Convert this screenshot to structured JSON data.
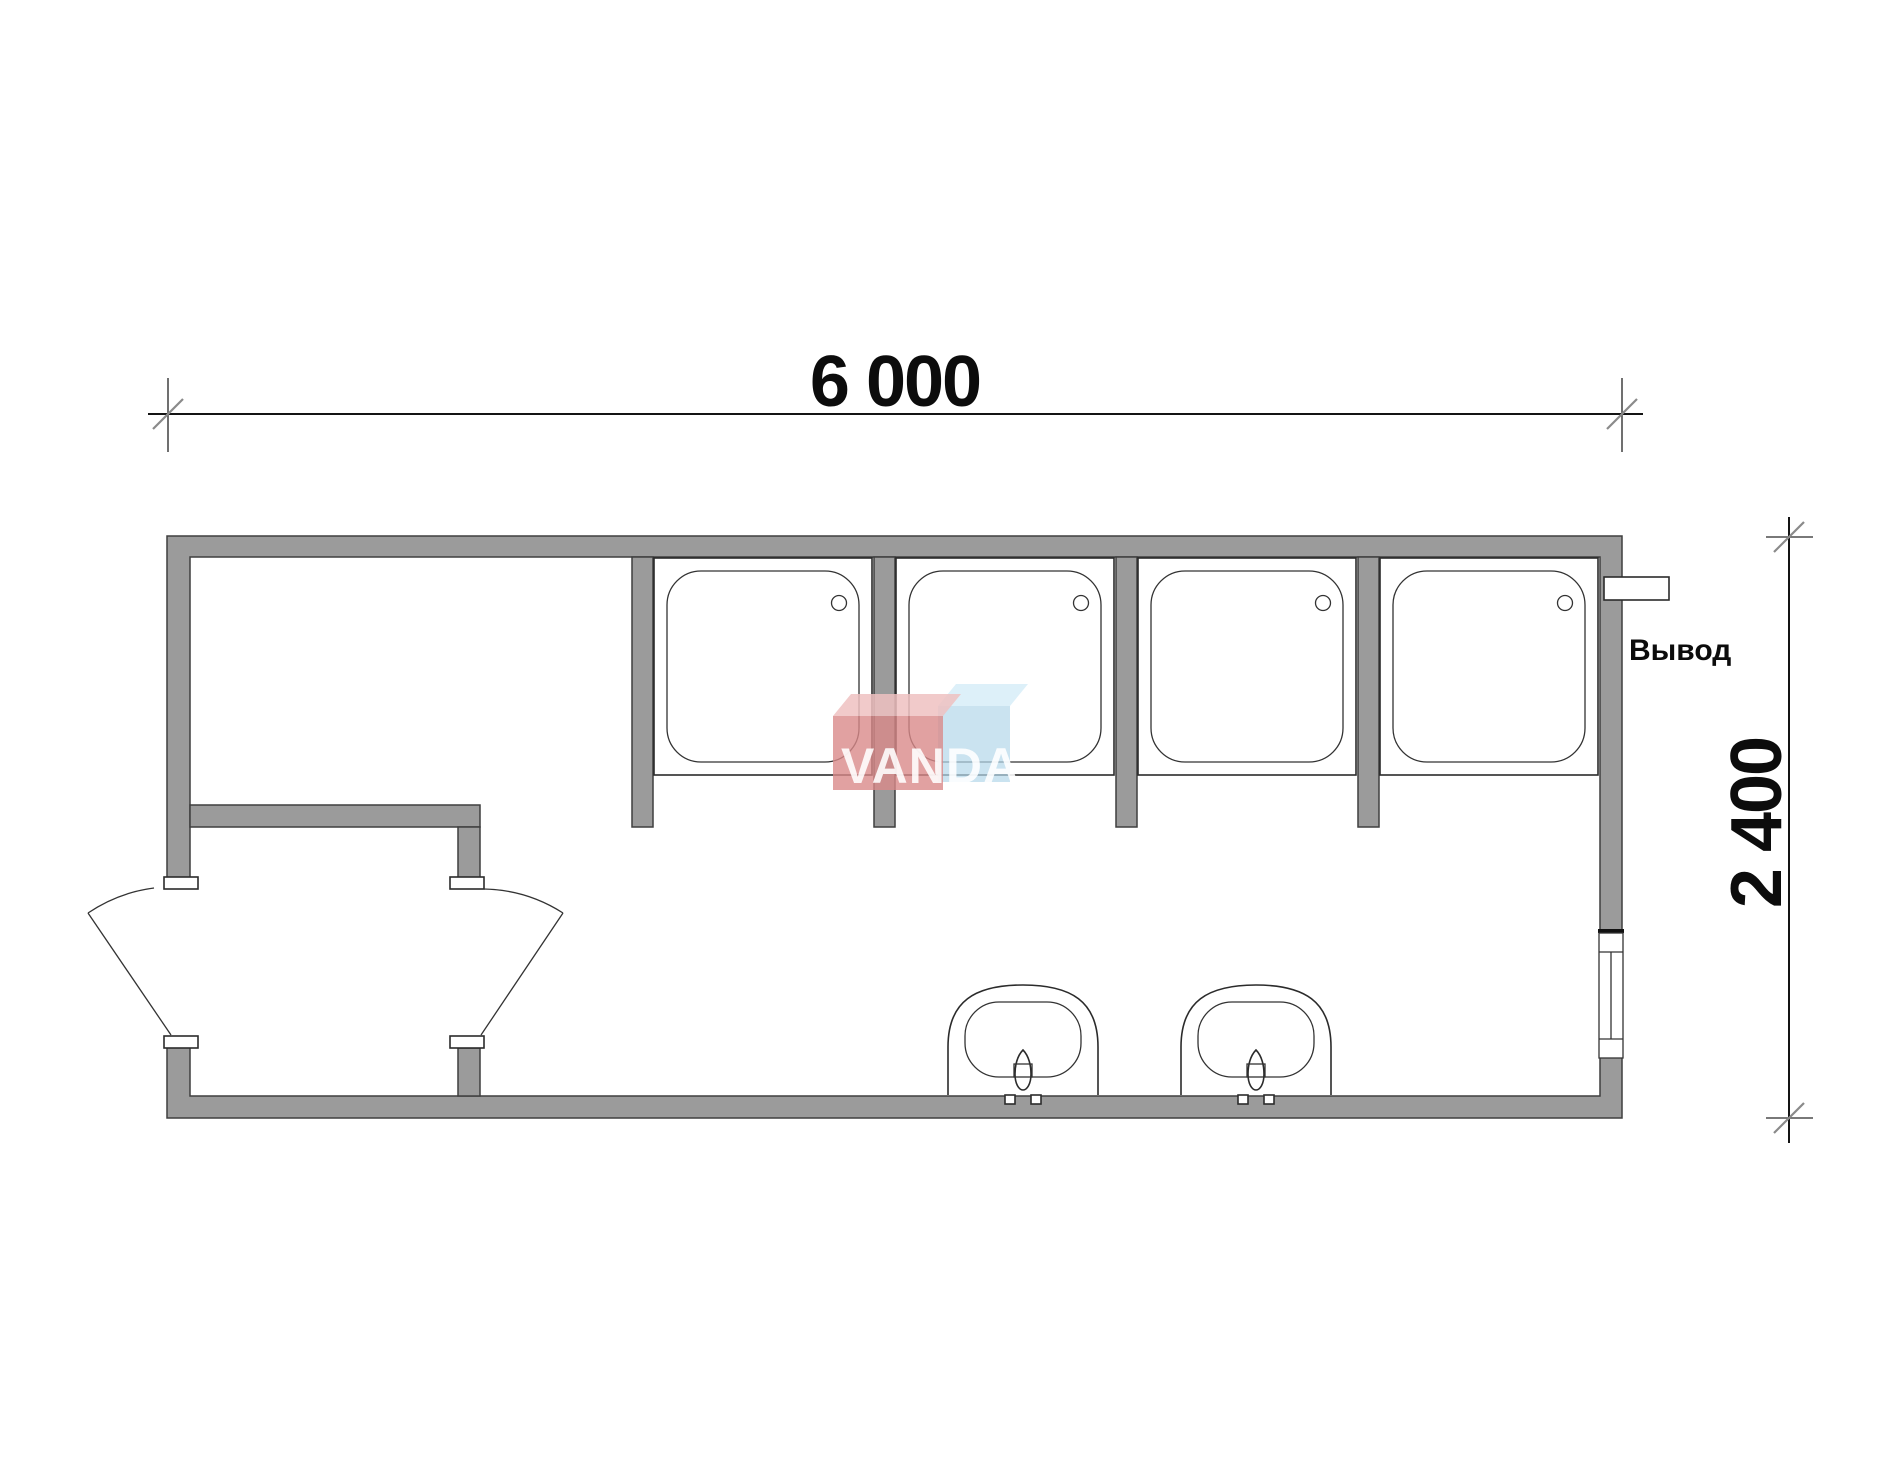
{
  "page": {
    "background": "#ffffff"
  },
  "dimensions": {
    "width": {
      "label": "6 000"
    },
    "height": {
      "label": "2 400"
    }
  },
  "annotations": {
    "outlet_label": "Вывод"
  },
  "watermark": {
    "brand": "VANDA"
  },
  "palette": {
    "wall_fill": "#9b9b9b",
    "watermark_red_front": "#d98a8a",
    "watermark_red_top": "#eec1c1",
    "watermark_blue_front": "#b3d7ea",
    "watermark_blue_top": "#cfeaf7",
    "watermark_text": "rgba(255,255,255,0.88)"
  },
  "plan": {
    "building": {
      "width_mm": 6000,
      "depth_mm": 2400
    },
    "shower_stalls": 4,
    "sinks": 2,
    "door_leaves": 2,
    "windows": 1,
    "outlets": 1
  }
}
